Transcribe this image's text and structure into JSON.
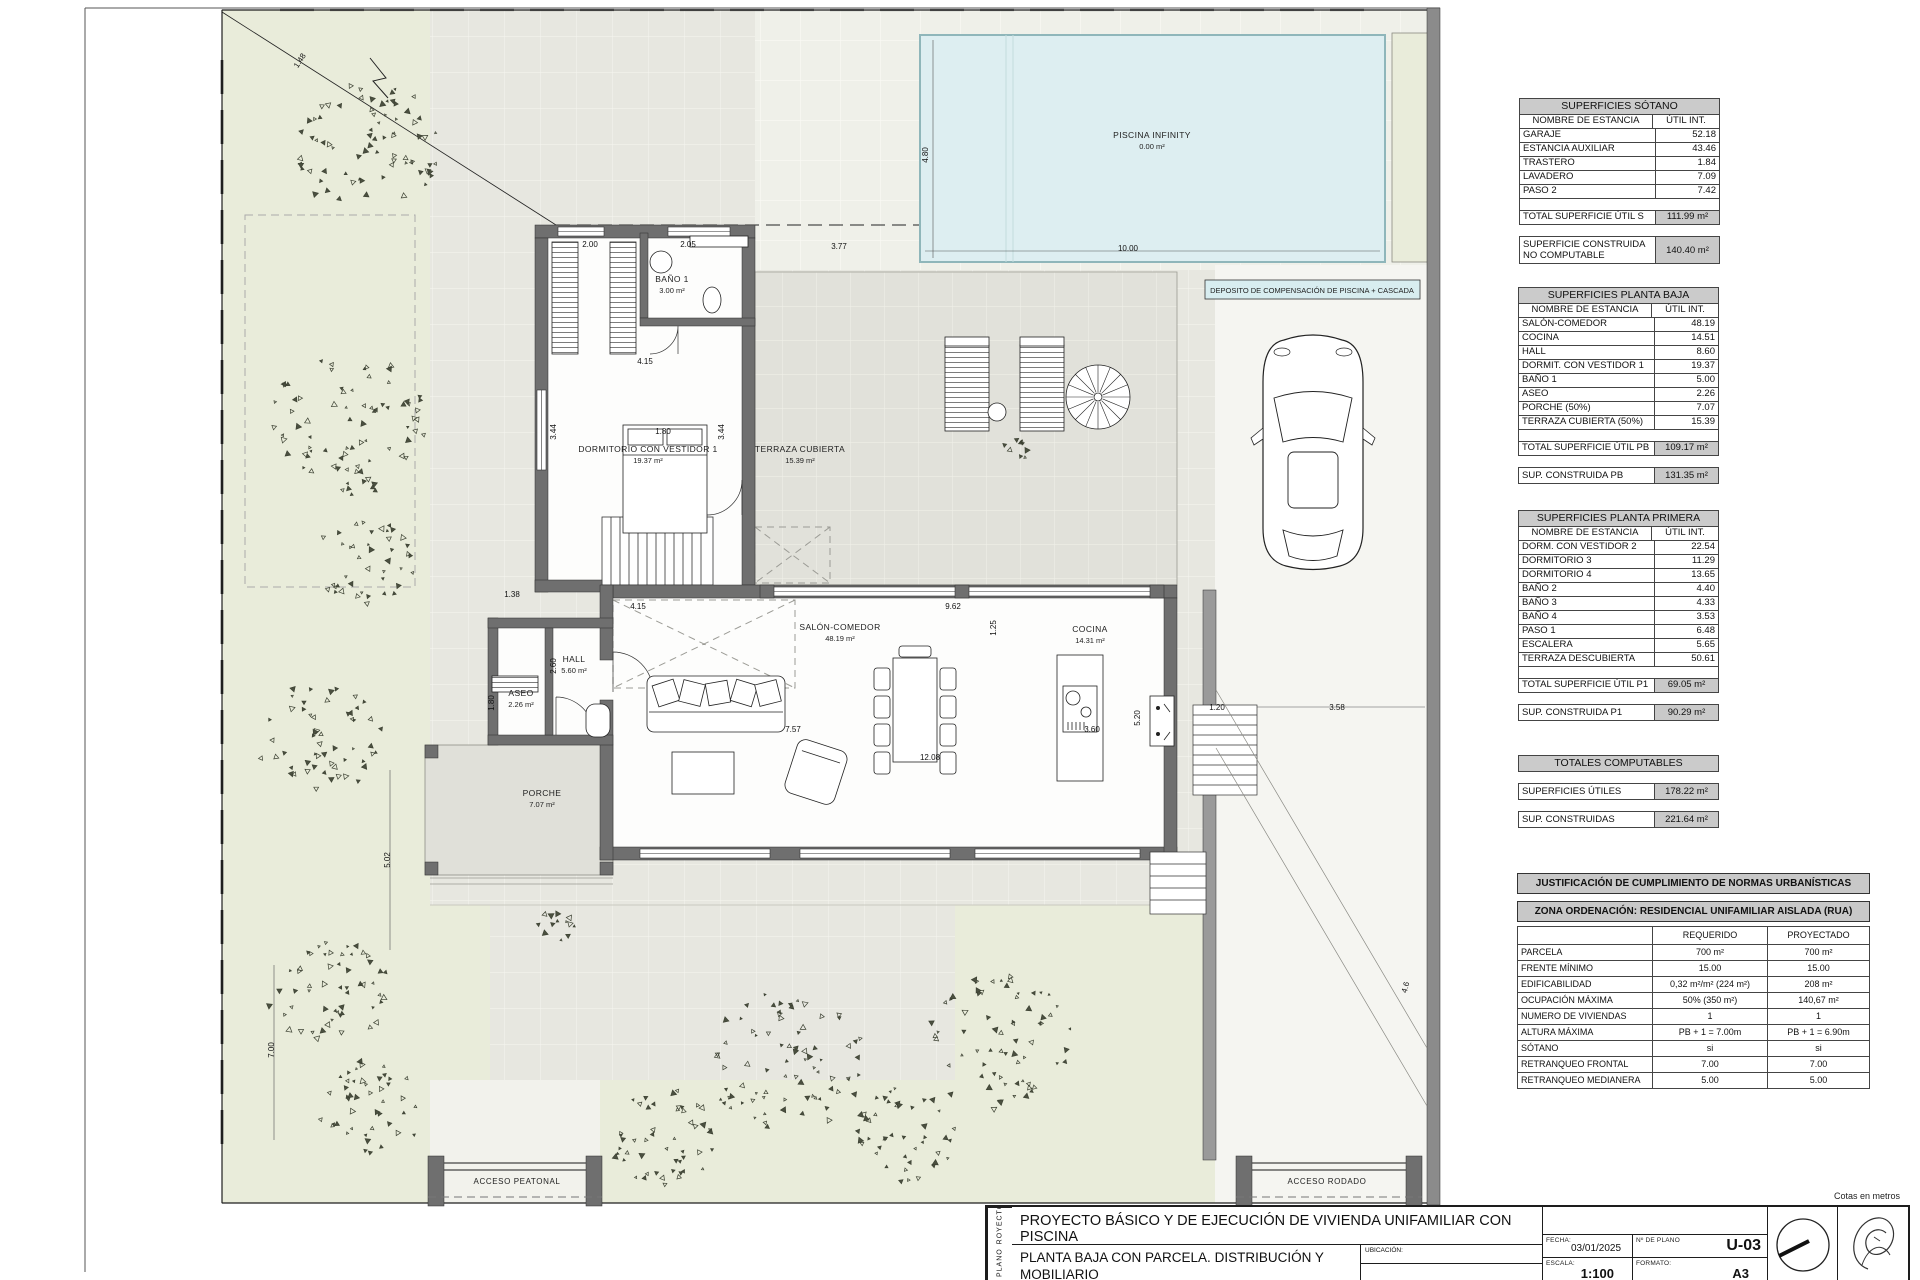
{
  "plan": {
    "deposito_label": "DEPOSITO DE COMPENSACIÓN DE PISCINA + CASCADA",
    "rooms": [
      {
        "name": "PISCINA INFINITY",
        "area": "0.00 m²",
        "x": 1152,
        "y": 138
      },
      {
        "name": "BAÑO 1",
        "area": "3.00 m²",
        "x": 672,
        "y": 282
      },
      {
        "name": "DORMITORIO CON VESTIDOR 1",
        "area": "19.37 m²",
        "x": 648,
        "y": 452
      },
      {
        "name": "TERRAZA CUBIERTA",
        "area": "15.39 m²",
        "x": 800,
        "y": 452
      },
      {
        "name": "SALÓN-COMEDOR",
        "area": "48.19 m²",
        "x": 840,
        "y": 630
      },
      {
        "name": "COCINA",
        "area": "14.31 m²",
        "x": 1090,
        "y": 632
      },
      {
        "name": "HALL",
        "area": "5.60 m²",
        "x": 574,
        "y": 662
      },
      {
        "name": "ASEO",
        "area": "2.26 m²",
        "x": 521,
        "y": 696
      },
      {
        "name": "PORCHE",
        "area": "7.07 m²",
        "x": 542,
        "y": 796
      }
    ],
    "notes": [
      {
        "t": "ACCESO PEATONAL",
        "x": 517,
        "y": 1184
      },
      {
        "t": "ACCESO RODADO",
        "x": 1327,
        "y": 1184
      }
    ],
    "dims": [
      {
        "t": "2.00",
        "x": 590,
        "y": 247
      },
      {
        "t": "2.05",
        "x": 688,
        "y": 247
      },
      {
        "t": "3.77",
        "x": 839,
        "y": 249
      },
      {
        "t": "4.80",
        "x": 928,
        "y": 155,
        "r": -90
      },
      {
        "t": "10.00",
        "x": 1128,
        "y": 251
      },
      {
        "t": "4.15",
        "x": 645,
        "y": 364
      },
      {
        "t": "3.44",
        "x": 556,
        "y": 432,
        "r": -90
      },
      {
        "t": "1.80",
        "x": 663,
        "y": 434
      },
      {
        "t": "3.44",
        "x": 724,
        "y": 432,
        "r": -90
      },
      {
        "t": "1.38",
        "x": 512,
        "y": 597
      },
      {
        "t": "4.15",
        "x": 638,
        "y": 609
      },
      {
        "t": "9.62",
        "x": 953,
        "y": 609
      },
      {
        "t": "1.25",
        "x": 996,
        "y": 628,
        "r": -90
      },
      {
        "t": "2.60",
        "x": 556,
        "y": 666,
        "r": -90
      },
      {
        "t": "1.80",
        "x": 494,
        "y": 703,
        "r": -90
      },
      {
        "t": "7.57",
        "x": 793,
        "y": 732
      },
      {
        "t": "3.60",
        "x": 1092,
        "y": 732
      },
      {
        "t": "5.20",
        "x": 1140,
        "y": 718,
        "r": -90
      },
      {
        "t": "1.20",
        "x": 1217,
        "y": 710
      },
      {
        "t": "3.58",
        "x": 1337,
        "y": 710
      },
      {
        "t": "12.08",
        "x": 930,
        "y": 760
      },
      {
        "t": "5.02",
        "x": 390,
        "y": 860,
        "r": -90
      },
      {
        "t": "7.00",
        "x": 274,
        "y": 1050,
        "r": -90
      },
      {
        "t": "4.6",
        "x": 1408,
        "y": 988,
        "r": -75
      },
      {
        "t": "1.48",
        "x": 302,
        "y": 62,
        "r": -57
      }
    ],
    "trees": [
      {
        "x": 368,
        "y": 148,
        "r": 72,
        "n": 75,
        "s": 1
      },
      {
        "x": 348,
        "y": 425,
        "r": 78,
        "n": 80,
        "s": 2
      },
      {
        "x": 362,
        "y": 560,
        "r": 52,
        "n": 42,
        "s": 3
      },
      {
        "x": 318,
        "y": 735,
        "r": 62,
        "n": 55,
        "s": 4
      },
      {
        "x": 330,
        "y": 990,
        "r": 60,
        "n": 55,
        "s": 5
      },
      {
        "x": 372,
        "y": 1105,
        "r": 52,
        "n": 45,
        "s": 6
      },
      {
        "x": 662,
        "y": 1135,
        "r": 55,
        "n": 50,
        "s": 7
      },
      {
        "x": 785,
        "y": 1060,
        "r": 80,
        "n": 78,
        "s": 8
      },
      {
        "x": 905,
        "y": 1135,
        "r": 52,
        "n": 45,
        "s": 9
      },
      {
        "x": 1002,
        "y": 1040,
        "r": 75,
        "n": 68,
        "s": 10
      },
      {
        "x": 557,
        "y": 928,
        "r": 18,
        "n": 13,
        "s": 11
      },
      {
        "x": 1018,
        "y": 449,
        "r": 13,
        "n": 9,
        "s": 12
      }
    ]
  },
  "tables": {
    "area_tables": [
      {
        "x": 1519,
        "y": 98,
        "title": "SUPERFICIES SÓTANO",
        "headers": [
          "NOMBRE DE ESTANCIA",
          "ÚTIL  INT."
        ],
        "rows": [
          [
            "GARAJE",
            "52.18"
          ],
          [
            "ESTANCIA AUXILIAR",
            "43.46"
          ],
          [
            "TRASTERO",
            "1.84"
          ],
          [
            "LAVADERO",
            "7.09"
          ],
          [
            "PASO 2",
            "7.42"
          ]
        ],
        "total": [
          "TOTAL SUPERFICIE ÚTIL S",
          "111.99 m²"
        ],
        "extras": [
          [
            "SUPERFICIE CONSTRUIDA NO COMPUTABLE",
            "140.40 m²"
          ]
        ]
      },
      {
        "x": 1518,
        "y": 287,
        "title": "SUPERFICIES  PLANTA BAJA",
        "headers": [
          "NOMBRE DE ESTANCIA",
          "ÚTIL  INT."
        ],
        "rows": [
          [
            "SALÓN-COMEDOR",
            "48.19"
          ],
          [
            "COCINA",
            "14.51"
          ],
          [
            "HALL",
            "8.60"
          ],
          [
            "DORMIT. CON VESTIDOR 1",
            "19.37"
          ],
          [
            "BAÑO 1",
            "5.00"
          ],
          [
            "ASEO",
            "2.26"
          ],
          [
            "PORCHE (50%)",
            "7.07"
          ],
          [
            "TERRAZA CUBIERTA (50%)",
            "15.39"
          ]
        ],
        "total": [
          "TOTAL SUPERFICIE ÚTIL PB",
          "109.17 m²"
        ],
        "extras": [
          [
            "SUP. CONSTRUIDA PB",
            "131.35 m²"
          ]
        ]
      },
      {
        "x": 1518,
        "y": 510,
        "title": "SUPERFICIES PLANTA PRIMERA",
        "headers": [
          "NOMBRE DE ESTANCIA",
          "ÚTIL  INT."
        ],
        "rows": [
          [
            "DORM. CON VESTIDOR 2",
            "22.54"
          ],
          [
            "DORMITORIO 3",
            "11.29"
          ],
          [
            "DORMITORIO 4",
            "13.65"
          ],
          [
            "BAÑO 2",
            "4.40"
          ],
          [
            "BAÑO 3",
            "4.33"
          ],
          [
            "BAÑO 4",
            "3.53"
          ],
          [
            "PASO 1",
            "6.48"
          ],
          [
            "ESCALERA",
            "5.65"
          ],
          [
            "TERRAZA DESCUBIERTA",
            "50.61"
          ]
        ],
        "total": [
          "TOTAL SUPERFICIE ÚTIL P1",
          "69.05 m²"
        ],
        "extras": [
          [
            "SUP. CONSTRUIDA P1",
            "90.29 m²"
          ]
        ]
      },
      {
        "x": 1518,
        "y": 755,
        "title": "TOTALES COMPUTABLES",
        "extras": [
          [
            "SUPERFICIES ÚTILES",
            "178.22 m²"
          ],
          [
            "SUP. CONSTRUIDAS",
            "221.64 m²"
          ]
        ]
      }
    ],
    "normas": {
      "title1": "JUSTIFICACIÓN DE CUMPLIMIENTO DE NORMAS URBANÍSTICAS",
      "title2": "ZONA ORDENACIÓN: RESIDENCIAL UNIFAMILIAR AISLADA (RUA)",
      "headers": [
        "",
        "REQUERIDO",
        "PROYECTADO"
      ],
      "rows": [
        [
          "PARCELA",
          "700 m²",
          "700 m²"
        ],
        [
          "FRENTE MÍNIMO",
          "15.00",
          "15.00"
        ],
        [
          "EDIFICABILIDAD",
          "0,32 m²/m² (224 m²)",
          "208 m²"
        ],
        [
          "OCUPACIÓN MÁXIMA",
          "50% (350 m²)",
          "140,67 m²"
        ],
        [
          "NUMERO DE VIVIENDAS",
          "1",
          "1"
        ],
        [
          "ALTURA MÁXIMA",
          "PB + 1 = 7.00m",
          "PB + 1 = 6.90m"
        ],
        [
          "SÓTANO",
          "si",
          "si"
        ],
        [
          "RETRANQUEO FRONTAL",
          "7.00",
          "7.00"
        ],
        [
          "RETRANQUEO MEDIANERA",
          "5.00",
          "5.00"
        ]
      ]
    }
  },
  "titleblock": {
    "proyecto_tag": "PROYECTO",
    "proyecto_text": "PROYECTO BÁSICO Y DE EJECUCIÓN DE  VIVIENDA UNIFAMILIAR CON PISCINA",
    "plano_tag": "PLANO",
    "plano_text": "PLANTA BAJA CON PARCELA. DISTRIBUCIÓN Y MOBILIARIO",
    "ubicacion_label": "UBICACIÓN:",
    "fecha_label": "FECHA:",
    "fecha_value": "03/01/2025",
    "nplano_label": "Nº DE PLANO",
    "nplano_value": "U-03",
    "escala_label": "ESCALA:",
    "escala_value": "1:100",
    "formato_label": "FORMATO:",
    "formato_value": "A3",
    "cotas_note": "Cotas en metros"
  }
}
